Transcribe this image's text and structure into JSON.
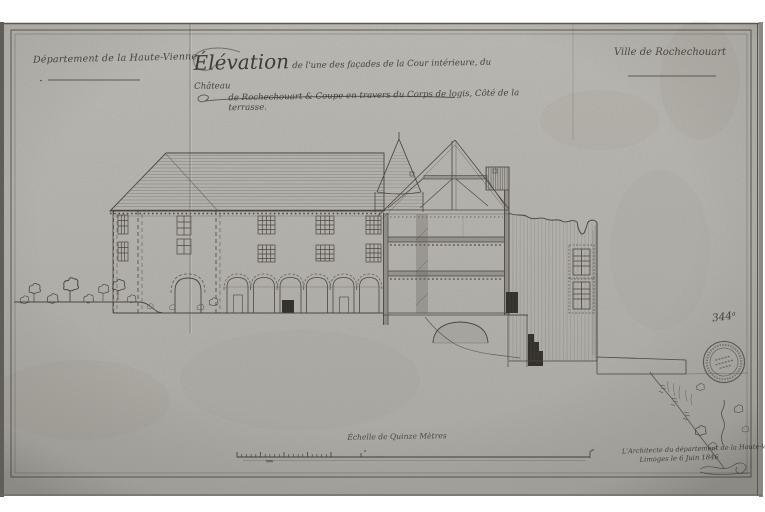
{
  "header": {
    "department": "Département de la Haute-Vienne",
    "city": "Ville de Rochechouart",
    "title_word": "Élévation",
    "title_line1_rest": "de l'une des façades de la Cour intérieure, du Château",
    "title_line2": "de Rochechouart & Coupe en travers du Corps de logis, Côté de la terrasse."
  },
  "annotations": {
    "inventory_number": "344ᵃ",
    "scale_label": "Échelle de Quinze Mètres",
    "signature_line1": "L'Architecte du département de la Haute-Vienne",
    "signature_line2": "Limoges le 6 Juin 1846"
  },
  "colors": {
    "paper": "#b6b4af",
    "ink": "#3b3731",
    "dark_fill": "#2d2a26"
  }
}
